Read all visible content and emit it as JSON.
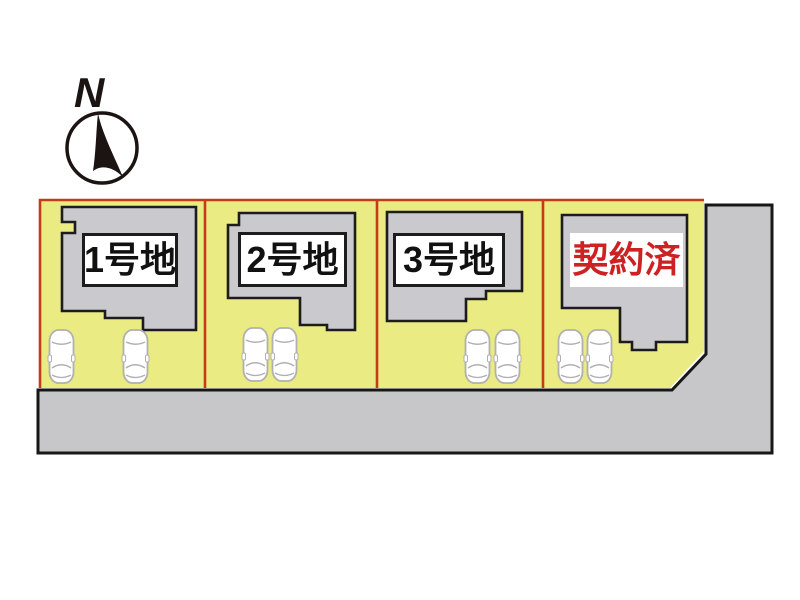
{
  "compass": {
    "north_label": "N"
  },
  "site_plan": {
    "lots": [
      {
        "label": "1号地",
        "sold": false
      },
      {
        "label": "2号地",
        "sold": false
      },
      {
        "label": "3号地",
        "sold": false
      },
      {
        "label": "契約済",
        "sold": true
      }
    ],
    "cars_per_lot": 2,
    "colors": {
      "lot_fill": "#ebeb83",
      "lot_boundary_red": "#c43b18",
      "building_fill": "#cacace",
      "building_outline": "#1c1c1c",
      "road_fill": "#c7c7c9",
      "road_outline": "#171717",
      "label_text": "#111111",
      "sold_text": "#cc2222",
      "compass_ink": "#1b1412"
    }
  }
}
